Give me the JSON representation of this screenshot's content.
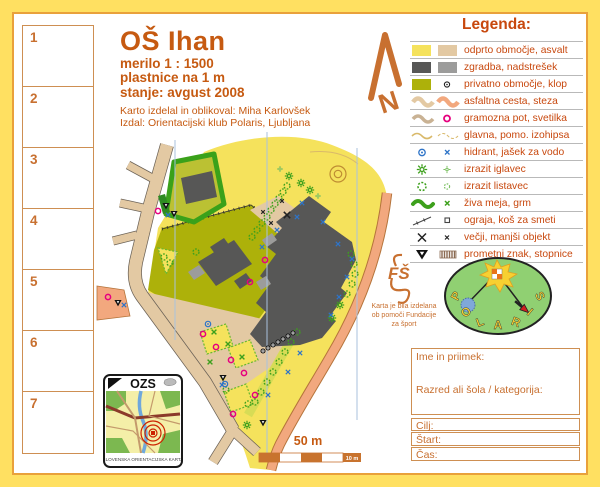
{
  "title_block": {
    "title": "OŠ Ihan",
    "scale_line": "merilo  1 : 1500",
    "contours_line": "plastnice na 1 m",
    "status_line": "stanje: avgust 2008",
    "credit_line1": "Karto izdelal in oblikoval: Miha Karlovšek",
    "credit_line2": "Izdal: Orientacijski klub Polaris, Ljubljana"
  },
  "north_arrow": {
    "label": "N"
  },
  "control_column": {
    "numbers": [
      "1",
      "2",
      "3",
      "4",
      "5",
      "6",
      "7"
    ]
  },
  "legend": {
    "title": "Legenda:",
    "items": [
      {
        "symbol": "open-area-asphalt",
        "label": "odprto območje, asvalt"
      },
      {
        "symbol": "building-canopy",
        "label": "zgradba, nadstrešek"
      },
      {
        "symbol": "private-area-bench",
        "label": "privatno območje, klop"
      },
      {
        "symbol": "asphalt-road-path",
        "label": "asfaltna cesta, steza"
      },
      {
        "symbol": "gravel-path-lamp",
        "label": "gramozna pot, svetilka"
      },
      {
        "symbol": "contour-lines",
        "label": "glavna, pomo. izohipsa"
      },
      {
        "symbol": "hydrant-manhole",
        "label": "hidrant, jašek za vodo"
      },
      {
        "symbol": "conifer-tree",
        "label": "izrazit iglavec"
      },
      {
        "symbol": "deciduous-tree",
        "label": "izrazit listavec"
      },
      {
        "symbol": "hedge-bush",
        "label": "živa meja, grm"
      },
      {
        "symbol": "fence-bin",
        "label": "ograja, koš za smeti"
      },
      {
        "symbol": "large-small-object",
        "label": "večji, manjši objekt"
      },
      {
        "symbol": "sign-stairs",
        "label": "prometni znak, stopnice"
      }
    ]
  },
  "scale_bar": {
    "label": "50 m",
    "segment_label": "10 m"
  },
  "ozs_card": {
    "title": "OZS",
    "caption": "SLOVENSKA ORIENTACIJSKA KARTA"
  },
  "funding_note": {
    "logo_text": "FŠ",
    "lines": [
      "Karta je bila izdelana",
      "ob pomoči Fundacije",
      "za šport"
    ]
  },
  "club_logo": {
    "letters": [
      "P",
      "O",
      "L",
      "A",
      "R",
      "I",
      "S"
    ]
  },
  "entry_form": {
    "name_label": "Ime in priimek:",
    "class_label": "Razred ali šola / kategorija:",
    "finish_label": "Cilj:",
    "start_label": "Štart:",
    "time_label": "Čas:"
  },
  "colors": {
    "frame_yellow": "#FFE061",
    "frame_line_orange": "#E9A13B",
    "accent_text": "#C65A11",
    "open_area_yellow": "#F5E25C",
    "asphalt_tan": "#E3C9A3",
    "road_peach": "#F2A87E",
    "building_dark": "#575756",
    "canopy_gray": "#9C9C9B",
    "private_olive": "#ADB10A",
    "hedge_green": "#3AA11A",
    "symbol_blue": "#2E74C8",
    "lamp_magenta": "#E6007E",
    "north_line_blue": "#A9C2DE"
  }
}
